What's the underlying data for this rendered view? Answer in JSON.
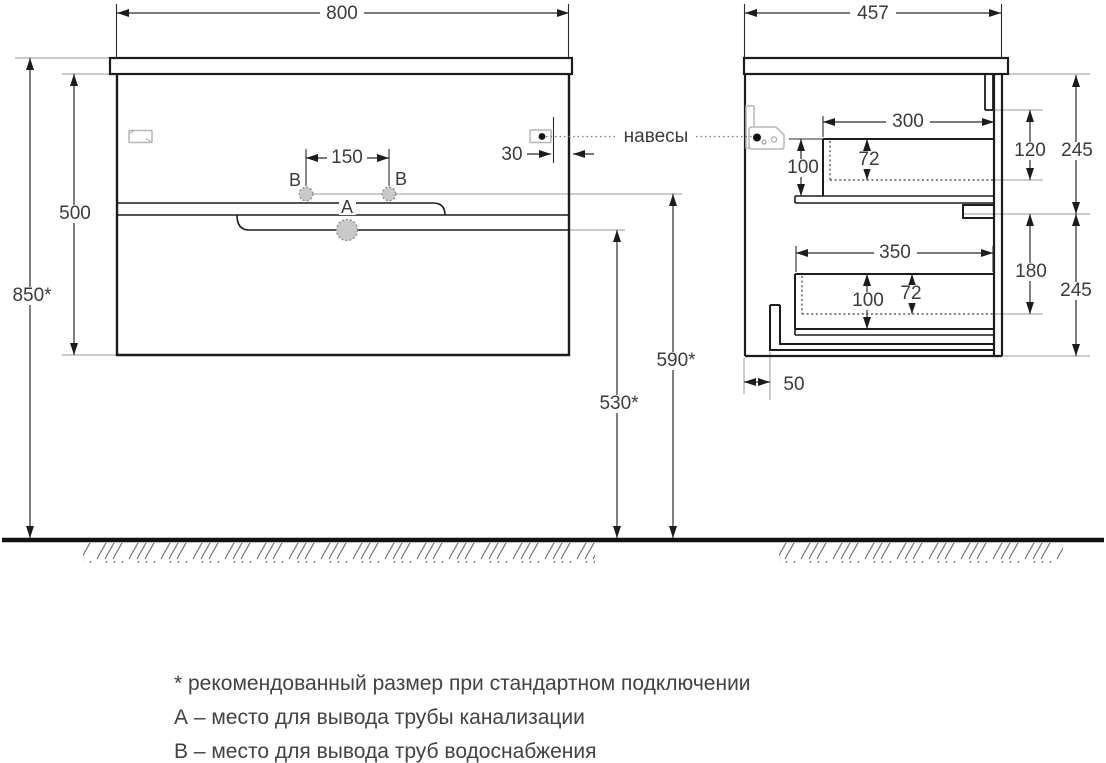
{
  "front_view": {
    "width": "800",
    "carcass_height": "500",
    "install_height": "850*",
    "supply_spacing": "150",
    "hinge_offset": "30",
    "drain_label": "A",
    "supply_label": "B"
  },
  "side_view": {
    "depth": "457",
    "upper_drawer": {
      "width": "300",
      "height": "100",
      "inner_height": "72"
    },
    "upper_offset": "120",
    "upper_section": "245",
    "lower_drawer": {
      "width": "350",
      "height": "100",
      "inner_height": "72"
    },
    "lower_offset": "180",
    "lower_section": "245",
    "plinth_recess": "50"
  },
  "connections": {
    "supply_height": "590*",
    "drain_height": "530*"
  },
  "callouts": {
    "hangers": "навесы"
  },
  "legend": {
    "note": "* рекомендованный размер при стандартном подключении",
    "a": "А – место для вывода трубы канализации",
    "b": "В – место для вывода труб водоснабжения"
  }
}
